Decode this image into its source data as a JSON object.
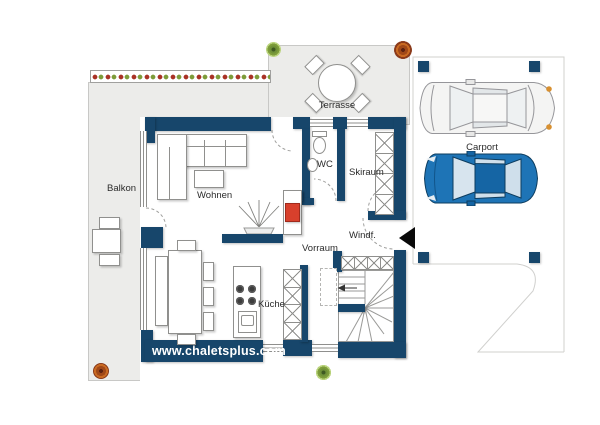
{
  "floor_plan": {
    "watermark": "www.chaletsplus.com",
    "labels": {
      "balcony": "Balkon",
      "terrace": "Terrasse",
      "living_room": "Wohnen",
      "wc": "WC",
      "ski_room": "Skiraum",
      "hallway": "Vorraum",
      "vestibule": "Windf.",
      "kitchen": "Küche",
      "carport": "Carport"
    },
    "colors": {
      "wall": "#17466b",
      "floor": "#ececea",
      "fireplace": "#d8402c",
      "car_blue": "#1e74b6",
      "car_silver": "#f4f4f3",
      "plant_green": "#7d9c3a",
      "plant_red": "#a93226"
    }
  }
}
